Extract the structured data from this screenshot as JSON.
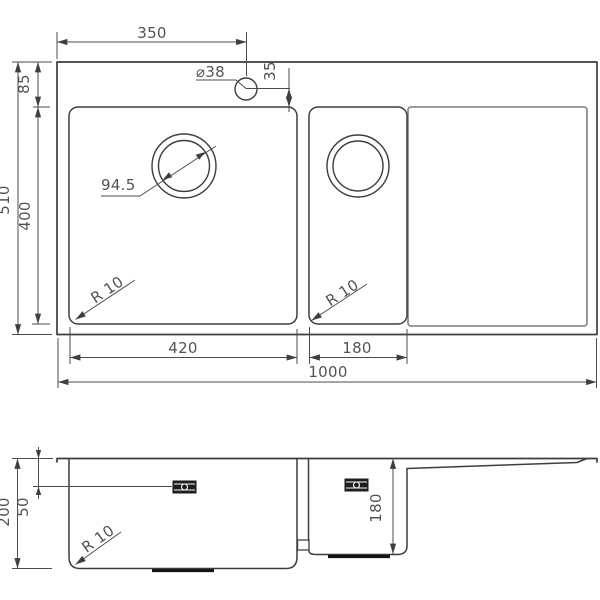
{
  "drawing": {
    "type": "technical sink drawing, plan view and section view",
    "colors": {
      "background": "#ffffff",
      "main_lines": "#3d3d3d",
      "dimension_lines": "#4c4c4c",
      "drainboard_lines": "#8e8e8e",
      "text": "#535353"
    },
    "top_view": {
      "faucet_offset": "350",
      "faucet_hole_diameter": "⌀38",
      "faucet_to_bowl": "35",
      "rim_to_bowl": "85",
      "overall_depth": "510",
      "bowl_depth": "400",
      "drain_diameter": "94.5",
      "left_bowl_corner_radius": "R 10",
      "right_bowl_corner_radius": "R 10",
      "left_bowl_width": "420",
      "right_bowl_width": "180",
      "overall_width": "1000"
    },
    "section_view": {
      "left_bowl_depth": "200",
      "drain_offset": "50",
      "right_bowl_depth": "180",
      "corner_radius": "R 10"
    }
  }
}
